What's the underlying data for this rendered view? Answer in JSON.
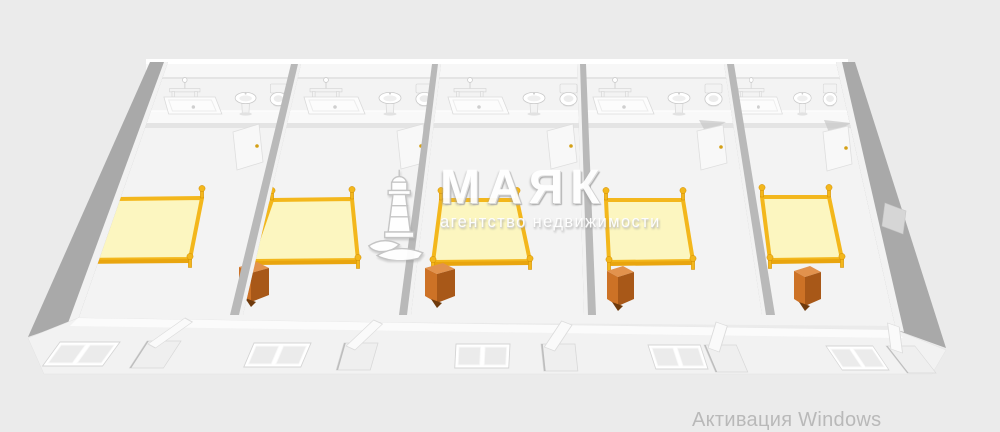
{
  "watermark": {
    "logo": "lighthouse-icon",
    "title": "МАЯК",
    "subtitle": "агентство недвижимости"
  },
  "system_overlay": {
    "activation_text": "Активация Windows"
  },
  "scene": {
    "type": "3d-floorplan-render",
    "view": "isometric-cutaway",
    "room_count": 5,
    "rooms": [
      {
        "name": "room-1",
        "furniture": [
          "towel-rail",
          "shower-tray",
          "sink",
          "toilet",
          "double-bed",
          "bathroom-door",
          "window",
          "front-door"
        ]
      },
      {
        "name": "room-2",
        "furniture": [
          "towel-rail",
          "shower-tray",
          "sink",
          "toilet",
          "double-bed",
          "nightstand",
          "bathroom-door",
          "window",
          "front-door"
        ]
      },
      {
        "name": "room-3",
        "furniture": [
          "towel-rail",
          "shower-tray",
          "sink",
          "toilet",
          "double-bed",
          "nightstand",
          "bathroom-door",
          "window",
          "front-door"
        ]
      },
      {
        "name": "room-4",
        "furniture": [
          "towel-rail",
          "shower-tray",
          "sink",
          "toilet",
          "double-bed",
          "nightstand",
          "bathroom-door",
          "window",
          "front-door"
        ]
      },
      {
        "name": "room-5",
        "furniture": [
          "towel-rail",
          "shower-tray",
          "sink",
          "toilet",
          "double-bed",
          "nightstand",
          "bathroom-door",
          "window",
          "front-door",
          "radiator"
        ]
      }
    ]
  },
  "colors": {
    "background": "#ebebeb",
    "floor": "#f3f3f3",
    "wall_face": "#b9b9b9",
    "bed_mattress": "#fcf6c0",
    "bed_frame": "#f3b71c",
    "bed_frame_dark": "#e9a50e",
    "nightstand_top": "#e2924d",
    "nightstand_front": "#cd7226",
    "nightstand_side": "#a85818",
    "nightstand_dark": "#6f3a0c",
    "watermark": "#ffffff",
    "activation_text": "#b9b9b9"
  }
}
